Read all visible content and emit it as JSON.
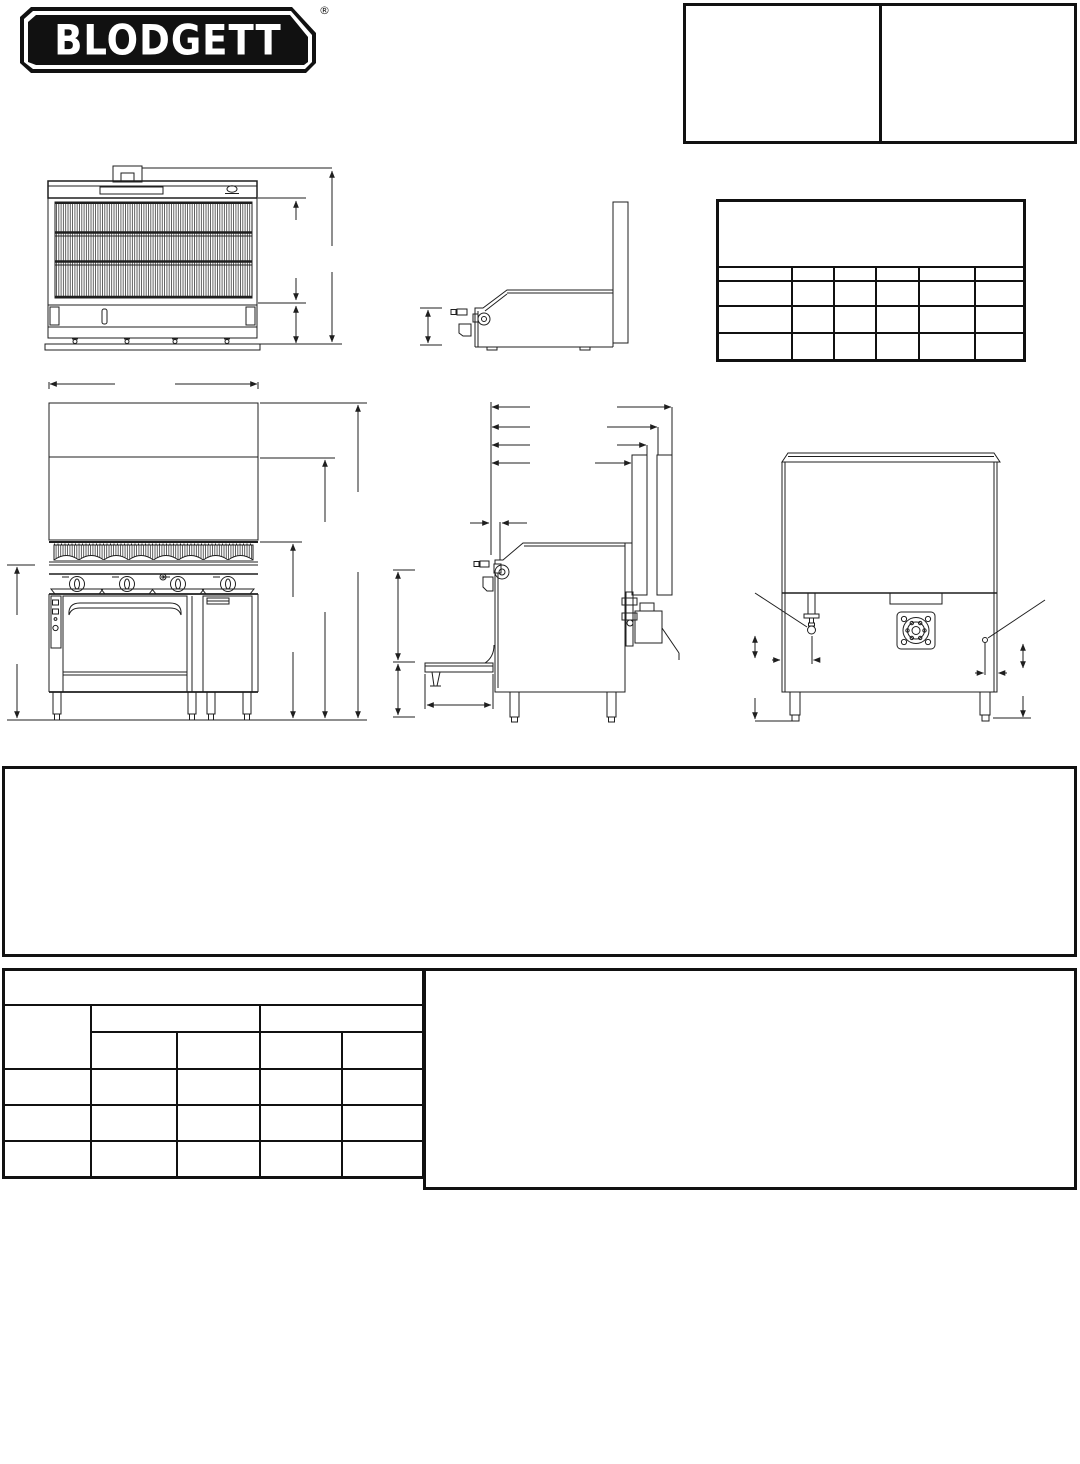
{
  "page": {
    "background": "#ffffff",
    "ink": "#1f1f1f",
    "width_px": 1080,
    "height_px": 1464
  },
  "logo": {
    "text": "BLODGETT",
    "registered_mark": "®",
    "badge_color": "#111111",
    "text_color": "#ffffff"
  },
  "header_form": {
    "left_cell_text": "",
    "right_cell_text": ""
  },
  "spec_table": {
    "title_block_text": "",
    "column_count": 6,
    "data_row_count": 3,
    "cell_text": ""
  },
  "drawings": {
    "broiler_front_view": "broiler section front elevation with grid and dimension lines",
    "broiler_side_view": "counter section side profile with rear flue riser",
    "range_front_view": "range front elevation: back riser, radiant broiler, four knobs, oven and cabinet",
    "range_side_view": "range side elevation with open oven door and gas connections",
    "range_rear_view": "range rear elevation with gas inlet flange and valve"
  },
  "notes_box": {
    "text": ""
  },
  "bottom_table": {
    "title_row_text": "",
    "left_column_header_text": "",
    "group_header_texts": [
      "",
      ""
    ],
    "sub_column_count": 4,
    "data_row_count": 3,
    "cell_text": ""
  },
  "bottom_right_box": {
    "text": ""
  }
}
